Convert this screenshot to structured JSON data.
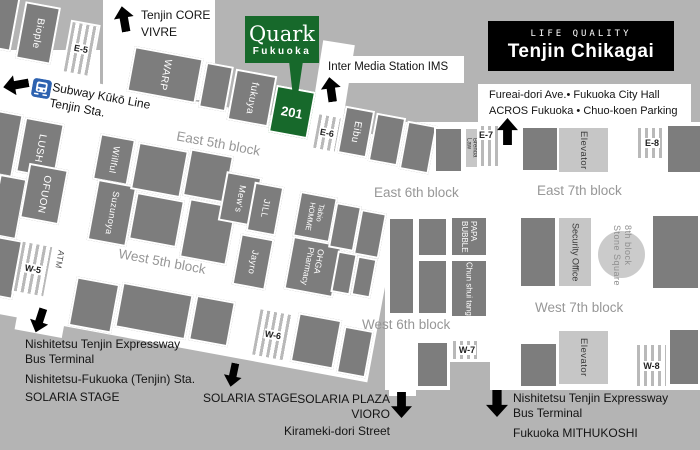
{
  "title": {
    "tagline": "LIFE QUALITY",
    "name": "Tenjin Chikagai"
  },
  "callout": {
    "brand": "Quark",
    "location": "Fukuoka",
    "unit": "201"
  },
  "streets": {
    "east5": "East 5th block",
    "east6": "East 6th block",
    "east7": "East 7th block",
    "west5": "West 5th block",
    "west6": "West 6th block",
    "west7": "West 7th block"
  },
  "exits": {
    "e5": "E-5",
    "e6": "E-6",
    "e7": "E-7",
    "e8": "E-8",
    "w5": "W-5",
    "w6": "W-6",
    "w7": "W-7",
    "w8": "W-8"
  },
  "stores": {
    "biople": "Biople",
    "warp": "WARP",
    "fukuya": "fukuya",
    "eibu": "Eibu",
    "brenda1": "Brenda",
    "brenda2": "Law",
    "lush": "LUSH",
    "ofuon": "OFUON",
    "willful": "Willful",
    "suzunoya": "Suzunoya",
    "mews": "Mew's",
    "jill": "JILL",
    "jayro": "Jayro",
    "tabio1": "Tabio",
    "tabio2": "HOMME",
    "ohga1": "OHGA",
    "ohga2": "Pharmacy",
    "papa1": "PAPA",
    "papa2": "BUBBLE",
    "chun": "Chun shui tang"
  },
  "facilities": {
    "elevator": "Elevator",
    "security": "Security Office",
    "atm": "ATM",
    "stone1": "8th block",
    "stone2": "Stone Square"
  },
  "landmarks": {
    "core1": "Tenjin CORE",
    "core2": "VIVRE",
    "subway1": "Subway Kūkō Line",
    "subway2": "Tenjin Sta.",
    "ims": "Inter Media Station IMS",
    "fureai1": "Fureai-dori Ave.• Fukuoka City Hall",
    "fureai2": "ACROS Fukuoka • Chuo-koen Parking",
    "sw1": "Nishitetsu Tenjin Expressway",
    "sw2": "Bus Terminal",
    "sw3": "Nishitetsu-Fukuoka (Tenjin) Sta.",
    "sw4": "SOLARIA STAGE",
    "solaria2": "SOLARIA STAGE",
    "plaza1": "SOLARIA PLAZA",
    "plaza2": "VIORO",
    "plaza3": "Kirameki-dori Street",
    "se1": "Nishitetsu Tenjin Expressway",
    "se2": "Bus Terminal",
    "se3": "Fukuoka MITHUKOSHI"
  },
  "colors": {
    "background": "#b4b4b4",
    "street": "#ffffff",
    "block": "#7d7d7d",
    "light_block": "#c6c6c6",
    "accent_green": "#17692b",
    "title_bg": "#000000",
    "street_label": "#979797",
    "subway_blue": "#2d62b0"
  }
}
